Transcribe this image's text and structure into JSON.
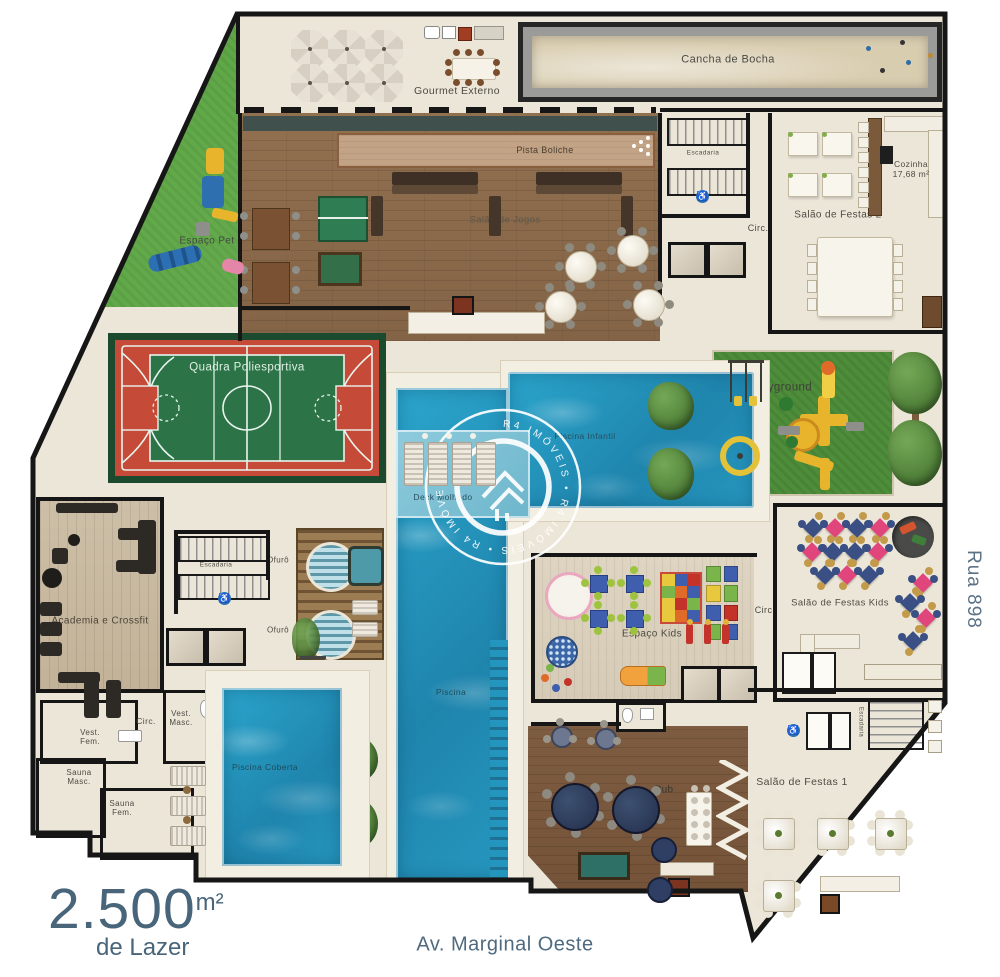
{
  "area": {
    "value": "2.500",
    "unit": "m²",
    "subtitle": "de Lazer"
  },
  "streets": {
    "bottom": "Av. Marginal Oeste",
    "right": "Rua 898"
  },
  "watermark": {
    "brand": "R4 Imóveis",
    "ring": "R4 IMÓVEIS • R4 IMÓVEIS • R4 IMÓVEIS •"
  },
  "rooms": {
    "bocha": "Cancha  de Bocha",
    "gourmet": "Gourmet Externo",
    "boliche": "Pista Boliche",
    "jogos": "Salão de Jogos",
    "escadaria": "Escadaria",
    "cozinha_name": "Cozinha",
    "cozinha_area": "17,68 m²",
    "festas2": "Salão de Festas 2",
    "circ": "Circ.",
    "pet": "Espaço Pet",
    "quadra": "Quadra Poliesportiva",
    "playground": "Playground",
    "infantil": "Piscina Infantil",
    "deck_molhado": "Deck Molhado",
    "ofuro": "Ofurô",
    "academia": "Academia e Crossfit",
    "festas_kids": "Salão de Festas Kids",
    "espaco_kids": "Espaço Kids",
    "piscina": "Piscina",
    "coberta": "Piscina Coberta",
    "vest_masc": "Vest. Masc.",
    "vest_fem": "Vest. Fem.",
    "sauna_masc": "Sauna Masc.",
    "sauna_fem": "Sauna Fem.",
    "pub": "Pub",
    "festas1": "Salão de Festas 1"
  },
  "colors": {
    "pool": "#2196bf",
    "grass": "#55a23b",
    "court_red": "#c64a38",
    "court_green": "#2c7447",
    "wood": "#8a6a4c",
    "sand": "#d9cdb0",
    "slate_text": "#4a6578",
    "wall": "#161616",
    "kids_pink": "#e0457b",
    "kids_navy": "#3a4f84"
  }
}
